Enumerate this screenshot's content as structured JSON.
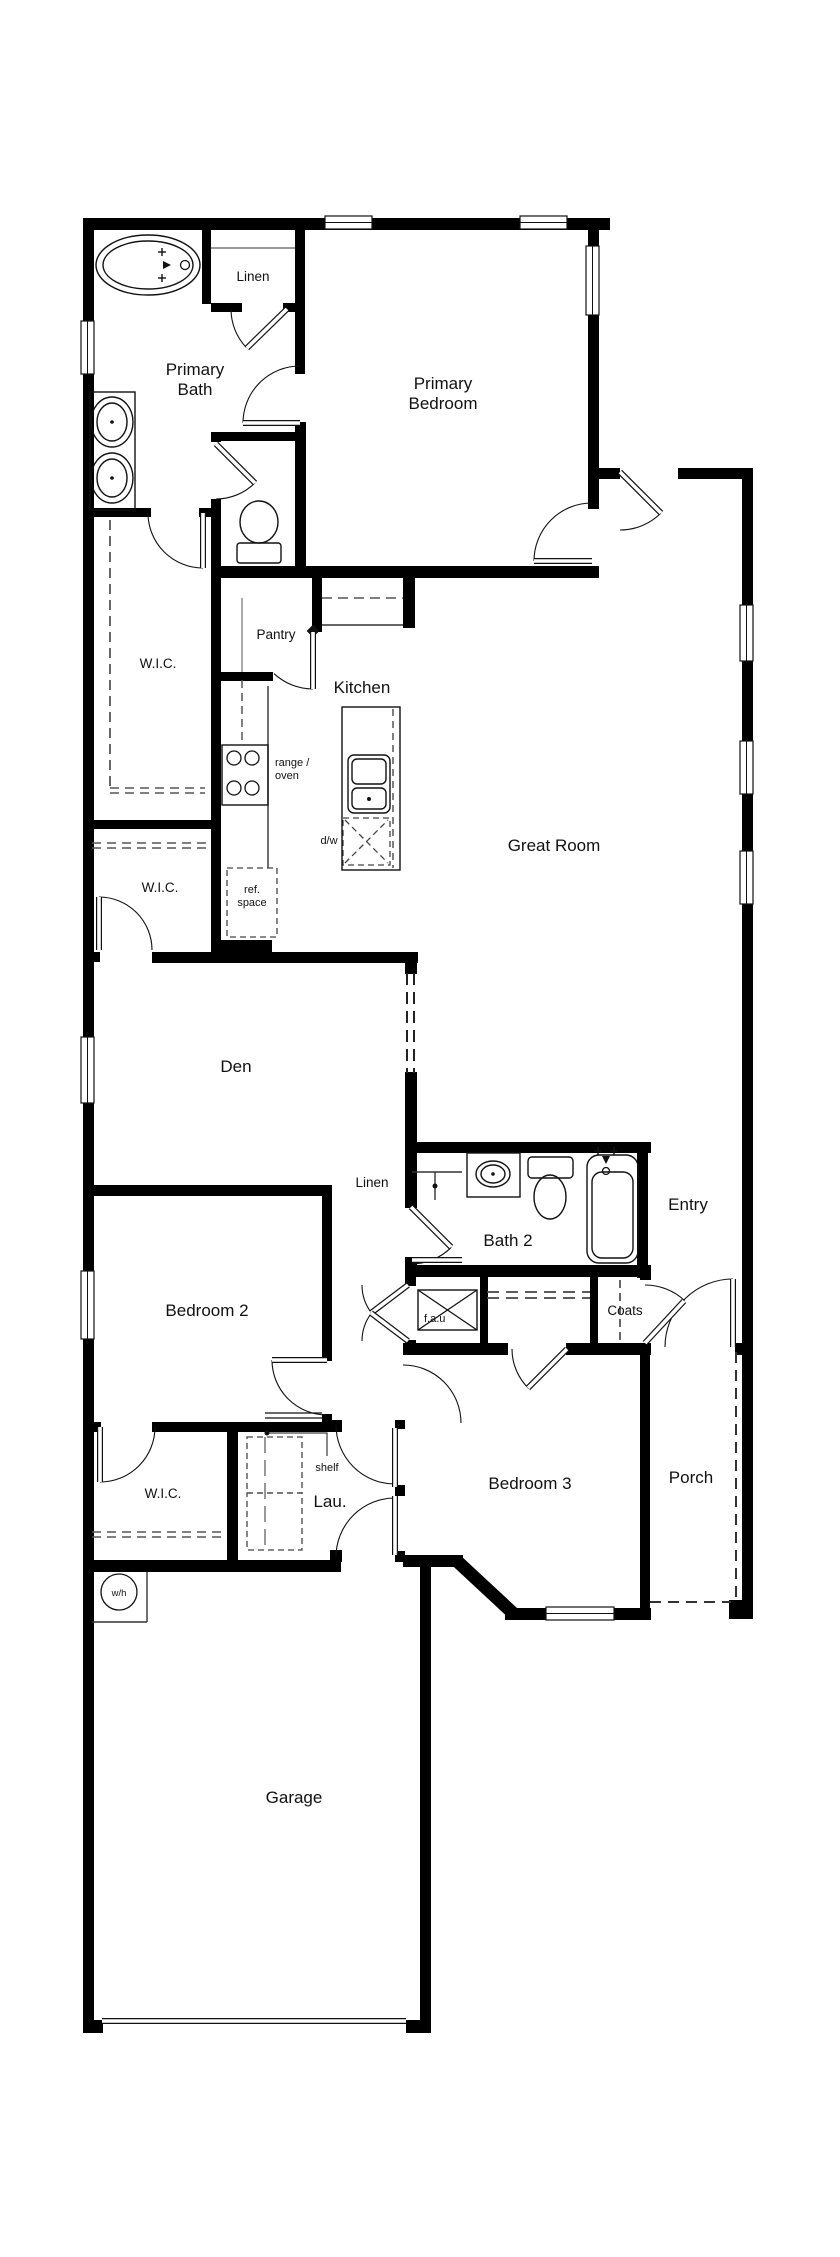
{
  "canvas": {
    "width": 840,
    "height": 2257,
    "background": "#ffffff",
    "wall_color": "#000000",
    "line_color": "#111111",
    "gray": "#555555"
  },
  "plan": {
    "labels": [
      {
        "name": "primary-bath",
        "text": "Primary\nBath",
        "x": 195,
        "y": 375,
        "size": 17,
        "anchor": "middle"
      },
      {
        "name": "linen-1",
        "text": "Linen",
        "x": 253,
        "y": 281,
        "size": 13.5,
        "anchor": "middle"
      },
      {
        "name": "primary-bedroom",
        "text": "Primary\nBedroom",
        "x": 443,
        "y": 389,
        "size": 17,
        "anchor": "middle"
      },
      {
        "name": "wic-1",
        "text": "W.I.C.",
        "x": 158,
        "y": 668,
        "size": 13.5,
        "anchor": "middle"
      },
      {
        "name": "pantry",
        "text": "Pantry",
        "x": 276,
        "y": 639,
        "size": 13.5,
        "anchor": "middle"
      },
      {
        "name": "kitchen",
        "text": "Kitchen",
        "x": 362,
        "y": 693,
        "size": 17,
        "anchor": "middle"
      },
      {
        "name": "range-oven",
        "text": "range /\noven",
        "x": 275,
        "y": 766,
        "size": 11,
        "anchor": "start"
      },
      {
        "name": "dw",
        "text": "d/w",
        "x": 329,
        "y": 844,
        "size": 11,
        "anchor": "middle"
      },
      {
        "name": "ref-space",
        "text": "ref.\nspace",
        "x": 252,
        "y": 893,
        "size": 11,
        "anchor": "middle"
      },
      {
        "name": "great-room",
        "text": "Great Room",
        "x": 554,
        "y": 851,
        "size": 17,
        "anchor": "middle"
      },
      {
        "name": "wic-2",
        "text": "W.I.C.",
        "x": 160,
        "y": 892,
        "size": 13.5,
        "anchor": "middle"
      },
      {
        "name": "den",
        "text": "Den",
        "x": 236,
        "y": 1072,
        "size": 17,
        "anchor": "middle"
      },
      {
        "name": "linen-2",
        "text": "Linen",
        "x": 372,
        "y": 1187,
        "size": 13.5,
        "anchor": "middle"
      },
      {
        "name": "bath-2",
        "text": "Bath 2",
        "x": 508,
        "y": 1246,
        "size": 17,
        "anchor": "middle"
      },
      {
        "name": "entry",
        "text": "Entry",
        "x": 688,
        "y": 1210,
        "size": 17,
        "anchor": "middle"
      },
      {
        "name": "bedroom-2",
        "text": "Bedroom 2",
        "x": 207,
        "y": 1316,
        "size": 17,
        "anchor": "middle"
      },
      {
        "name": "fau",
        "text": "f.a.u",
        "x": 424,
        "y": 1322,
        "size": 11,
        "anchor": "start"
      },
      {
        "name": "coats",
        "text": "Coats",
        "x": 625,
        "y": 1315,
        "size": 13.5,
        "anchor": "middle"
      },
      {
        "name": "wic-3",
        "text": "W.I.C.",
        "x": 163,
        "y": 1498,
        "size": 13.5,
        "anchor": "middle"
      },
      {
        "name": "shelf",
        "text": "shelf",
        "x": 327,
        "y": 1471,
        "size": 11,
        "anchor": "middle"
      },
      {
        "name": "lau",
        "text": "Lau.",
        "x": 330,
        "y": 1507,
        "size": 17,
        "anchor": "middle"
      },
      {
        "name": "bedroom-3",
        "text": "Bedroom 3",
        "x": 530,
        "y": 1489,
        "size": 17,
        "anchor": "middle"
      },
      {
        "name": "porch",
        "text": "Porch",
        "x": 691,
        "y": 1483,
        "size": 17,
        "anchor": "middle"
      },
      {
        "name": "wh",
        "text": "w/h",
        "x": 119,
        "y": 1596,
        "size": 9.5,
        "anchor": "middle"
      },
      {
        "name": "garage",
        "text": "Garage",
        "x": 294,
        "y": 1803,
        "size": 17,
        "anchor": "middle"
      }
    ],
    "walls": [
      [
        83,
        218,
        527,
        12
      ],
      [
        83,
        218,
        11,
        1814
      ],
      [
        83,
        2020,
        20,
        13
      ],
      [
        406,
        2020,
        25,
        13
      ],
      [
        420,
        1561,
        11,
        472
      ],
      [
        403,
        1555,
        60,
        12
      ],
      [
        505,
        1608,
        146,
        12
      ],
      [
        729,
        1600,
        23,
        19
      ],
      [
        742,
        468,
        11,
        1151
      ],
      [
        598,
        468,
        22,
        11
      ],
      [
        678,
        468,
        75,
        11
      ],
      [
        588,
        218,
        11,
        291
      ],
      [
        202,
        228,
        9,
        76
      ],
      [
        211,
        303,
        31,
        9
      ],
      [
        283,
        303,
        21,
        9
      ],
      [
        295,
        218,
        10,
        156
      ],
      [
        295,
        422,
        11,
        148
      ],
      [
        211,
        432,
        94,
        9
      ],
      [
        211,
        432,
        10,
        10
      ],
      [
        211,
        499,
        10,
        463
      ],
      [
        92,
        508,
        59,
        9
      ],
      [
        199,
        508,
        22,
        9
      ],
      [
        211,
        566,
        388,
        12
      ],
      [
        92,
        820,
        123,
        9
      ],
      [
        92,
        952,
        8,
        10
      ],
      [
        152,
        952,
        68,
        11
      ],
      [
        218,
        940,
        54,
        13
      ],
      [
        218,
        952,
        200,
        11
      ],
      [
        405,
        952,
        12,
        22
      ],
      [
        405,
        1072,
        12,
        76
      ],
      [
        312,
        573,
        10,
        59
      ],
      [
        403,
        573,
        12,
        55
      ],
      [
        221,
        672,
        52,
        9
      ],
      [
        83,
        1185,
        246,
        11
      ],
      [
        322,
        1185,
        10,
        176
      ],
      [
        322,
        1414,
        10,
        18
      ],
      [
        405,
        1142,
        246,
        11
      ],
      [
        405,
        1148,
        12,
        50
      ],
      [
        405,
        1196,
        12,
        12
      ],
      [
        405,
        1257,
        12,
        16
      ],
      [
        637,
        1152,
        11,
        126
      ],
      [
        405,
        1265,
        246,
        12
      ],
      [
        405,
        1277,
        11,
        9
      ],
      [
        405,
        1340,
        11,
        14
      ],
      [
        480,
        1277,
        8,
        71
      ],
      [
        590,
        1277,
        8,
        71
      ],
      [
        640,
        1265,
        11,
        15
      ],
      [
        403,
        1343,
        105,
        12
      ],
      [
        566,
        1343,
        85,
        12
      ],
      [
        735,
        1343,
        18,
        12
      ],
      [
        640,
        1355,
        10,
        265
      ],
      [
        92,
        1422,
        9,
        10
      ],
      [
        152,
        1422,
        172,
        10
      ],
      [
        395,
        1420,
        10,
        9
      ],
      [
        395,
        1485,
        10,
        11
      ],
      [
        395,
        1551,
        10,
        11
      ],
      [
        330,
        1420,
        12,
        12
      ],
      [
        330,
        1550,
        12,
        12
      ],
      [
        227,
        1422,
        11,
        148
      ],
      [
        83,
        1560,
        258,
        12
      ]
    ],
    "diag_walls": [
      [
        458,
        1562,
        515,
        1615,
        13
      ]
    ],
    "windows": [
      [
        325,
        216,
        47,
        13,
        "h"
      ],
      [
        520,
        216,
        47,
        13,
        "h"
      ],
      [
        586,
        246,
        13,
        69,
        "v"
      ],
      [
        81,
        321,
        13,
        53,
        "v"
      ],
      [
        81,
        1037,
        13,
        66,
        "v"
      ],
      [
        81,
        1271,
        13,
        68,
        "v"
      ],
      [
        740,
        605,
        13,
        56,
        "v"
      ],
      [
        740,
        741,
        13,
        53,
        "v"
      ],
      [
        740,
        851,
        13,
        53,
        "v"
      ],
      [
        546,
        1607,
        68,
        13,
        "h"
      ]
    ],
    "door_arcs": [
      [
        300,
        423,
        57,
        180,
        270
      ],
      [
        287,
        309,
        56,
        137,
        180
      ],
      [
        216,
        444,
        55,
        45,
        90
      ],
      [
        203,
        513,
        55,
        90,
        180
      ],
      [
        592,
        561,
        58,
        180,
        270
      ],
      [
        620,
        472,
        58,
        45,
        90
      ],
      [
        313,
        632,
        57,
        90,
        133
      ],
      [
        99,
        950,
        53,
        270,
        360
      ],
      [
        327,
        1360,
        55,
        90,
        180
      ],
      [
        411,
        1207,
        57,
        45,
        90
      ],
      [
        408,
        1285,
        46,
        143,
        180
      ],
      [
        408,
        1341,
        46,
        180,
        217
      ],
      [
        645,
        1343,
        58,
        270,
        313
      ],
      [
        733,
        1347,
        68,
        180,
        270
      ],
      [
        567,
        1349,
        55,
        134,
        180
      ],
      [
        395,
        1425,
        59,
        90,
        180
      ],
      [
        395,
        1557,
        59,
        180,
        270
      ],
      [
        403,
        1423,
        58,
        270,
        360
      ],
      [
        100,
        1427,
        55,
        0,
        90
      ]
    ],
    "door_leaves": [
      [
        243,
        423,
        300,
        423
      ],
      [
        287,
        309,
        247,
        348
      ],
      [
        216,
        444,
        255,
        483
      ],
      [
        203,
        513,
        203,
        568
      ],
      [
        534,
        561,
        592,
        561
      ],
      [
        620,
        472,
        661,
        513
      ],
      [
        313,
        632,
        313,
        689
      ],
      [
        99,
        897,
        99,
        950
      ],
      [
        272,
        1360,
        327,
        1360
      ],
      [
        411,
        1207,
        451,
        1247
      ],
      [
        412,
        1260,
        462,
        1260
      ],
      [
        408,
        1285,
        371,
        1313
      ],
      [
        408,
        1341,
        371,
        1313
      ],
      [
        645,
        1343,
        684,
        1301
      ],
      [
        733,
        1279,
        733,
        1347
      ],
      [
        567,
        1349,
        528,
        1388
      ],
      [
        395,
        1428,
        395,
        1487
      ],
      [
        395,
        1496,
        395,
        1555
      ],
      [
        100,
        1427,
        100,
        1482
      ],
      [
        102,
        2021,
        406,
        2021
      ]
    ],
    "thin_lines": [
      [
        211,
        248,
        295,
        248,
        2,
        "#999999"
      ],
      [
        322,
        625,
        403,
        625,
        1.4,
        "#333333"
      ],
      [
        268,
        686,
        268,
        868,
        1.4,
        "#333333"
      ],
      [
        242,
        598,
        242,
        672,
        1.4,
        "#888888"
      ],
      [
        412,
        1172,
        462,
        1172,
        1.4,
        "#333333"
      ],
      [
        435,
        1172,
        435,
        1200,
        1.4,
        "#333333"
      ],
      [
        147,
        1572,
        147,
        1622,
        1.4,
        "#333333"
      ],
      [
        92,
        1622,
        147,
        1622,
        1.4,
        "#333333"
      ],
      [
        265,
        1413,
        322,
        1413,
        1.3,
        "#111111"
      ],
      [
        265,
        1418,
        322,
        1418,
        1.3,
        "#111111"
      ],
      [
        418,
        1290,
        477,
        1330,
        1.3,
        "#111111"
      ],
      [
        418,
        1330,
        477,
        1290,
        1.3,
        "#111111"
      ]
    ],
    "dash_lines": [
      [
        110,
        520,
        110,
        788,
        1.8,
        "10 6",
        "#555555"
      ],
      [
        110,
        788,
        205,
        788,
        1.6,
        "9 6",
        "#555555"
      ],
      [
        110,
        793,
        205,
        793,
        1.6,
        "9 6",
        "#555555"
      ],
      [
        92,
        843,
        212,
        843,
        1.6,
        "9 6",
        "#555555"
      ],
      [
        92,
        848,
        212,
        848,
        1.6,
        "9 6",
        "#555555"
      ],
      [
        92,
        1532,
        227,
        1532,
        1.6,
        "9 6",
        "#555555"
      ],
      [
        92,
        1537,
        227,
        1537,
        1.6,
        "9 6",
        "#555555"
      ],
      [
        322,
        598,
        403,
        598,
        1.5,
        "10 6",
        "#555555"
      ],
      [
        242,
        680,
        242,
        745,
        1.5,
        "8 5",
        "#555555"
      ],
      [
        393,
        709,
        393,
        868,
        1.5,
        "7 5",
        "#555555"
      ],
      [
        407,
        973,
        407,
        1073,
        2,
        "12 7",
        "#222222"
      ],
      [
        414,
        973,
        414,
        1073,
        2,
        "12 7",
        "#222222"
      ],
      [
        487,
        1292,
        590,
        1292,
        1.8,
        "12 7",
        "#444444"
      ],
      [
        487,
        1298,
        590,
        1298,
        1.8,
        "12 7",
        "#444444"
      ],
      [
        620,
        1280,
        620,
        1340,
        1.8,
        "8 5",
        "#555555"
      ],
      [
        736,
        1352,
        736,
        1598,
        2,
        "11 7",
        "#333333"
      ],
      [
        650,
        1602,
        731,
        1602,
        2,
        "11 7",
        "#333333"
      ],
      [
        265,
        1437,
        265,
        1550,
        1.2,
        "16 7",
        "#555555"
      ],
      [
        345,
        820,
        388,
        863,
        1.3,
        "6 4",
        "#444444"
      ],
      [
        345,
        863,
        388,
        820,
        1.3,
        "6 4",
        "#444444"
      ]
    ],
    "dash_rects": [
      [
        227,
        868,
        50,
        69
      ],
      [
        343,
        818,
        47,
        47
      ],
      [
        247,
        1437,
        55,
        56
      ],
      [
        247,
        1493,
        55,
        57
      ]
    ],
    "fixture_rects": [
      [
        90,
        392,
        45,
        118,
        0
      ],
      [
        222,
        745,
        46,
        60,
        0
      ],
      [
        342,
        707,
        58,
        163,
        0
      ],
      [
        348,
        755,
        42,
        58,
        6
      ],
      [
        352,
        759,
        34,
        25,
        5
      ],
      [
        352,
        788,
        34,
        21,
        5
      ],
      [
        467,
        1153,
        53,
        44,
        0
      ],
      [
        528,
        1157,
        45,
        21,
        4
      ],
      [
        587,
        1155,
        51,
        108,
        12
      ],
      [
        592,
        1172,
        41,
        86,
        10
      ],
      [
        237,
        543,
        44,
        20,
        3
      ],
      [
        418,
        1290,
        59,
        40,
        0
      ]
    ],
    "ellipses": [
      [
        148,
        265,
        52,
        30
      ],
      [
        148,
        265,
        45,
        24
      ],
      [
        112,
        422,
        21,
        25
      ],
      [
        112,
        422,
        15,
        19
      ],
      [
        112,
        478,
        21,
        25
      ],
      [
        112,
        478,
        15,
        19
      ],
      [
        259,
        522,
        19,
        21
      ],
      [
        493,
        1174,
        17,
        13
      ],
      [
        493,
        1174,
        12,
        9
      ],
      [
        550,
        1197,
        16,
        22
      ]
    ],
    "circles": [
      [
        234,
        758,
        7
      ],
      [
        252,
        758,
        7
      ],
      [
        234,
        788,
        7
      ],
      [
        252,
        788,
        7
      ],
      [
        119,
        1592,
        18
      ],
      [
        185,
        265,
        4.5
      ],
      [
        606,
        1171,
        3.5
      ]
    ],
    "dots": [
      [
        369,
        799,
        2
      ],
      [
        112,
        422,
        1.8
      ],
      [
        112,
        478,
        1.8
      ],
      [
        493,
        1174,
        1.8
      ],
      [
        267,
        1433,
        2.5
      ],
      [
        435,
        1186,
        2.5
      ]
    ],
    "plus_marks": [
      [
        162,
        252
      ],
      [
        162,
        278
      ],
      [
        598,
        1151
      ],
      [
        614,
        1151
      ]
    ],
    "triangles": [
      [
        167,
        265,
        "r"
      ],
      [
        606,
        1160,
        "d"
      ]
    ],
    "diamonds": [
      [
        313,
        631,
        9
      ]
    ],
    "leader_line": [
      [
        267,
        1433
      ],
      [
        327,
        1433
      ],
      [
        327,
        1456
      ]
    ]
  }
}
